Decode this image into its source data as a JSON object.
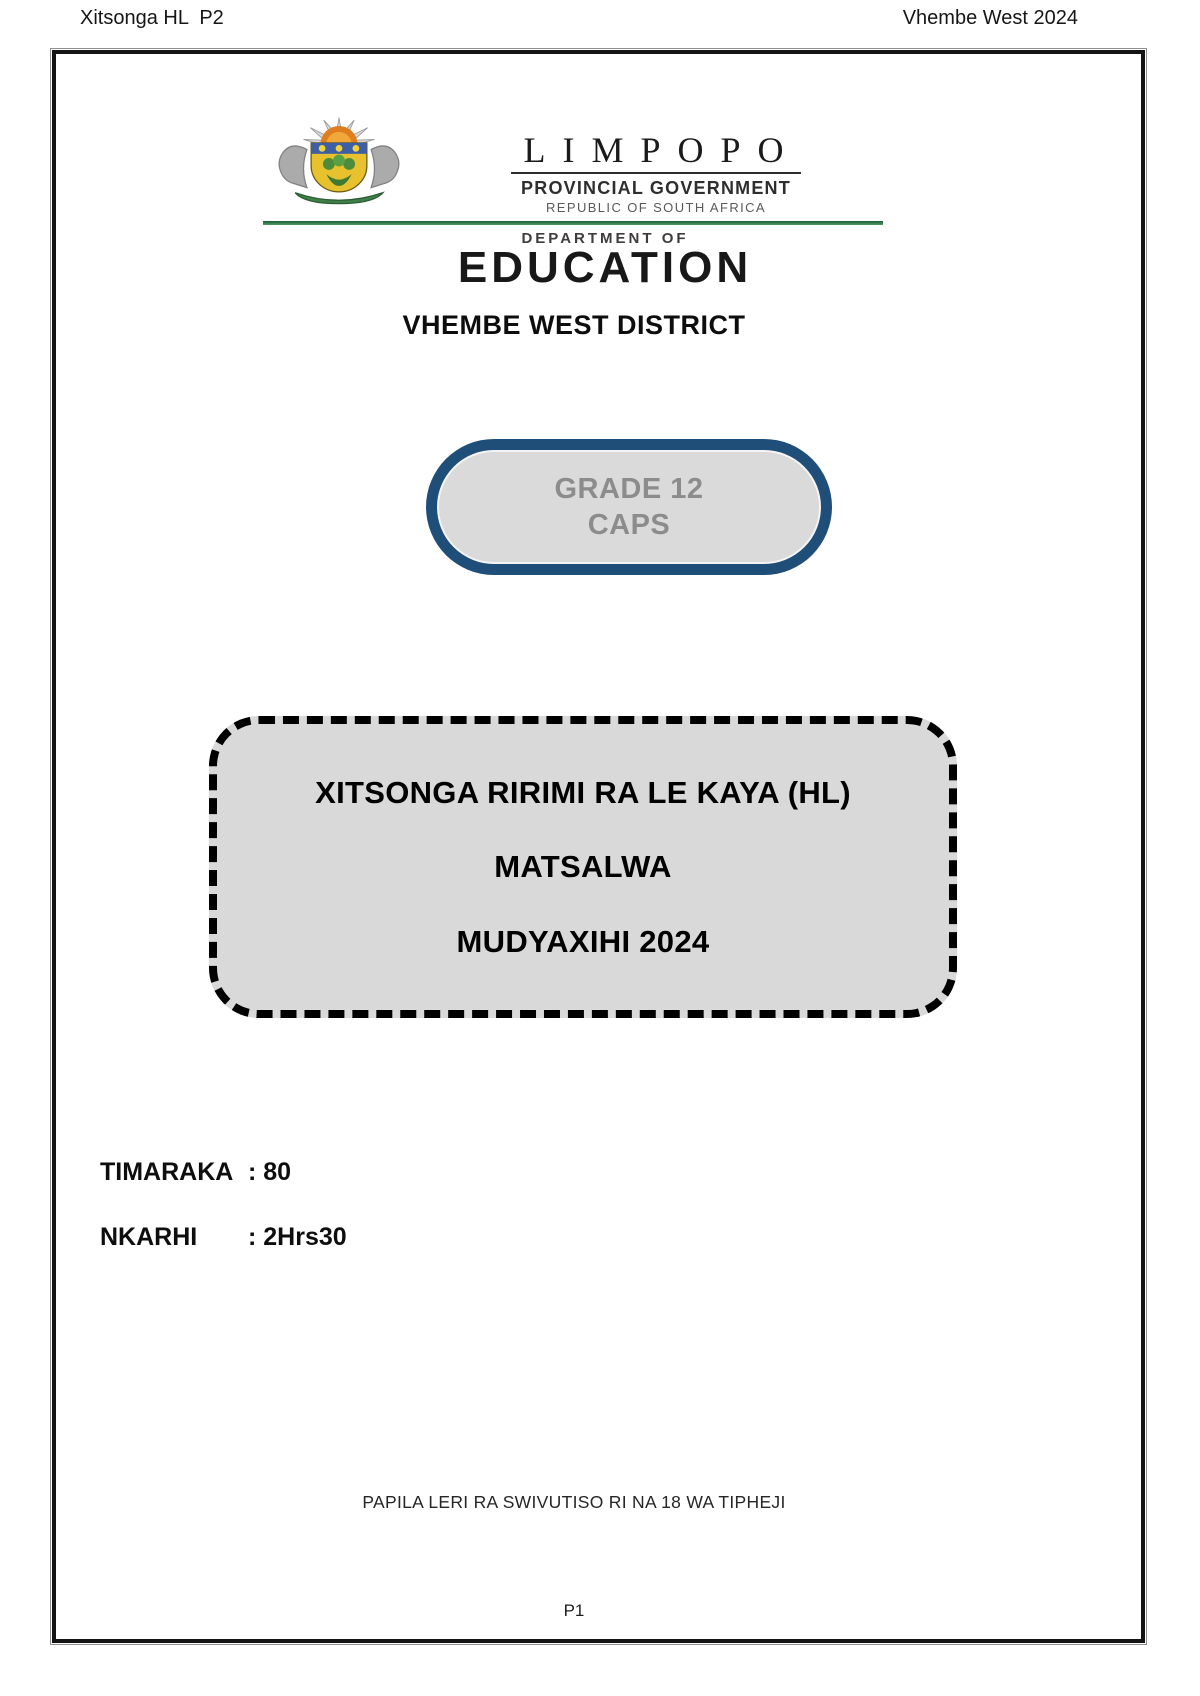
{
  "header": {
    "left": "Xitsonga HL  P2",
    "right": "Vhembe West 2024"
  },
  "logo": {
    "province": "LIMPOPO",
    "government": "PROVINCIAL GOVERNMENT",
    "republic": "REPUBLIC OF SOUTH AFRICA",
    "department_of": "DEPARTMENT OF",
    "department_name": "EDUCATION"
  },
  "district_title": "VHEMBE WEST DISTRICT",
  "grade_badge": {
    "grade": "GRADE 12",
    "curriculum": "CAPS"
  },
  "subject_box": {
    "subject": "XITSONGA RIRIMI RA LE KAYA (HL)",
    "paper": "MATSALWA",
    "session": "MUDYAXIHI 2024"
  },
  "details": [
    {
      "label": "TIMARAKA",
      "value": ": 80"
    },
    {
      "label": "NKARHI",
      "value": ": 2Hrs30"
    }
  ],
  "footer_note": "PAPILA LERI RA SWIVUTISO RI NA 18 WA TIPHEJI",
  "page_number": "P1",
  "colors": {
    "badge_border_blue": "#1F4E79",
    "panel_gray": "#D9D9D9",
    "badge_text_gray": "#8C8C8C",
    "divider_green": "#2E7D4A"
  }
}
